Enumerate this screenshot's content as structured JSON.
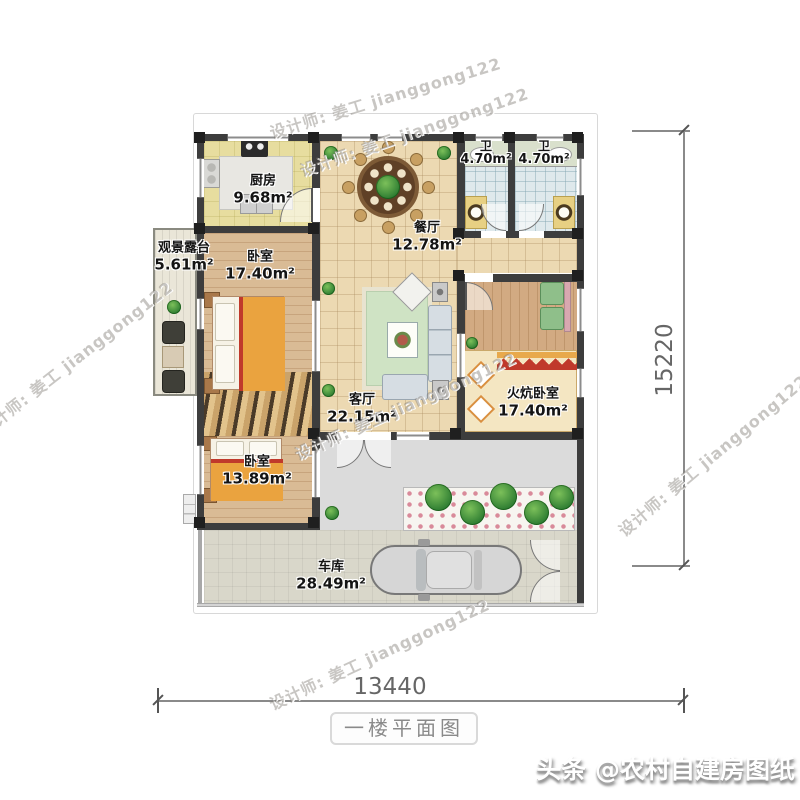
{
  "caption": "一楼平面图",
  "branding": "头条 @农村自建房图纸",
  "watermark": "设计师: 姜工 jianggong122",
  "dimensions": {
    "width": "13440",
    "height": "15220"
  },
  "rooms": {
    "kitchen": {
      "name": "厨房",
      "area": "9.68m²"
    },
    "dining": {
      "name": "餐厅",
      "area": "12.78m²"
    },
    "bath_left": {
      "name": "卫",
      "area": "4.70m²"
    },
    "bath_right": {
      "name": "卫",
      "area": "4.70m²"
    },
    "terrace": {
      "name": "观景露台",
      "area": "5.61m²"
    },
    "bedroom_left": {
      "name": "卧室",
      "area": "17.40m²"
    },
    "living": {
      "name": "客厅",
      "area": "22.15m²"
    },
    "kang_bedroom": {
      "name": "火炕卧室",
      "area": "17.40m²"
    },
    "bedroom_bottom": {
      "name": "卧室",
      "area": "13.89m²"
    },
    "garage": {
      "name": "车库",
      "area": "28.49m²"
    }
  },
  "colors": {
    "wall": "#3d3d3d",
    "floor_tile": "#ecd9b2",
    "floor_wood": "#d9bb95",
    "bath_blue": "#dfe9ec",
    "rug_green": "#cfe3c4",
    "kang_orange": "#e8a94c",
    "accent_red": "#c0392b"
  }
}
